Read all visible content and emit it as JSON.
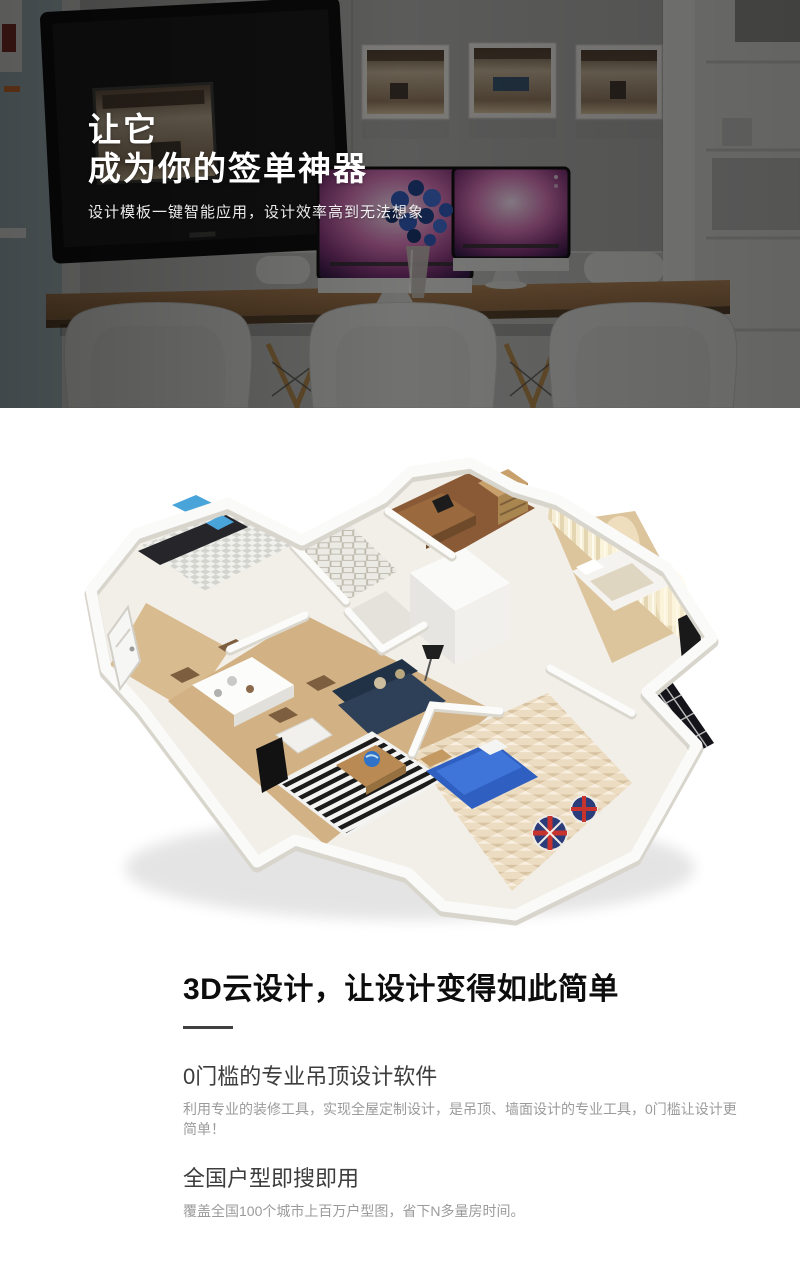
{
  "hero": {
    "title": "让它\n成为你的签单神器",
    "subtitle": "设计模板一键智能应用，设计效率高到无法想象"
  },
  "section": {
    "heading": "3D云设计，让设计变得如此简单",
    "features": [
      {
        "title": "0门槛的专业吊顶设计软件",
        "body": "利用专业的装修工具，实现全屋定制设计，是吊顶、墙面设计的专业工具，0门槛让设计更简单！"
      },
      {
        "title": "全国户型即搜即用",
        "body": "覆盖全国100个城市上百万户型图，省下N多量房时间。"
      }
    ]
  },
  "palette": {
    "accent_orange": "#cf6d2f",
    "screen_pink": "#cf6fb0",
    "flower_blue": "#2c55b4",
    "sofa_navy": "#2e4057",
    "kids_bed_blue": "#2f5fc0",
    "beanbag_red": "#c8332e",
    "beanbag_navy": "#2b3c7a",
    "wood_floor": "#d2b284",
    "divider_gray": "#3f3f3f",
    "body_text_gray": "#9b9b9b"
  }
}
